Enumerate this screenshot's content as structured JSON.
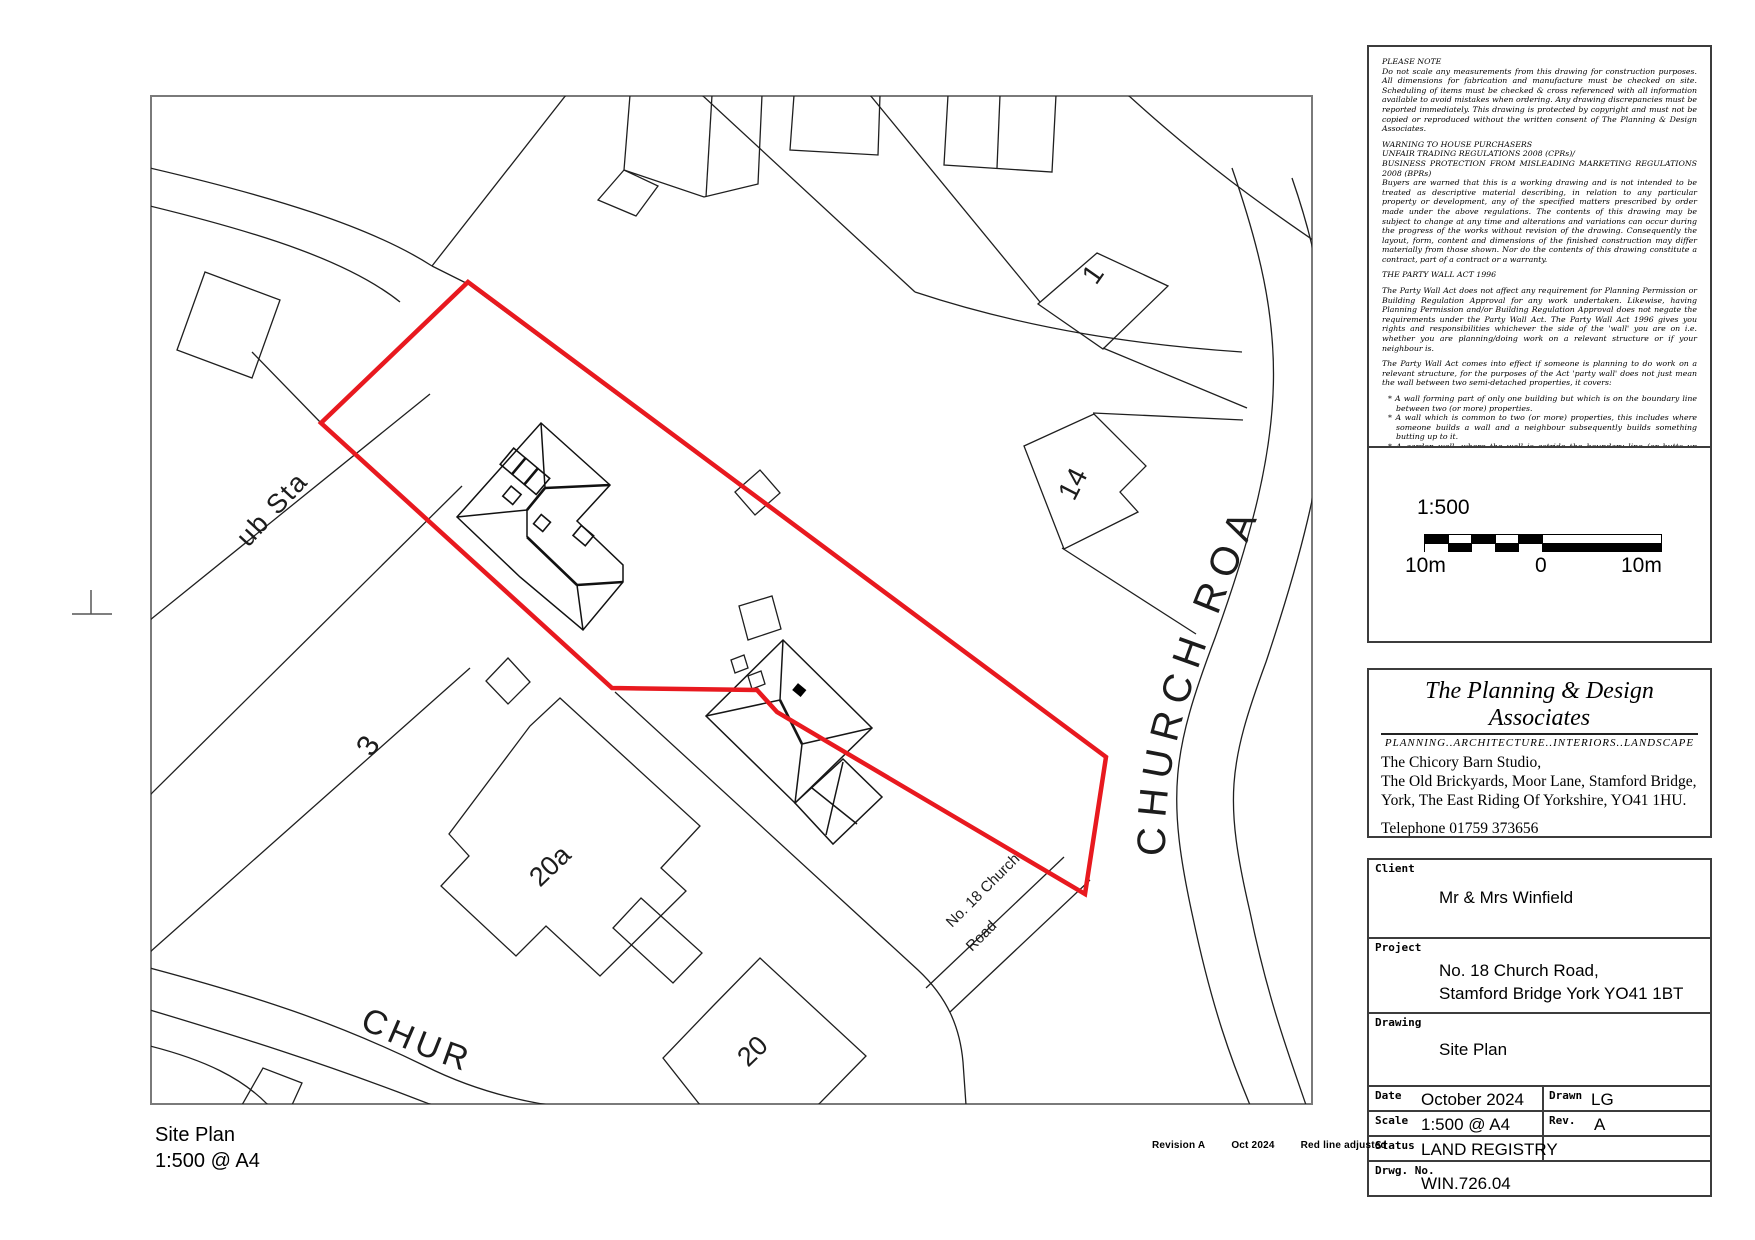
{
  "plan": {
    "boundary_color": "#e8191f",
    "labels": {
      "substation": "ub Sta",
      "plot3": "3",
      "plot20a": "20a",
      "plot20": "20",
      "plot1": "1",
      "plot14": "14",
      "road_right": "CHURCH ROA",
      "road_bottom": "CHUR",
      "subject_line1": "No. 18 Church",
      "subject_line2": "Road"
    }
  },
  "notes": {
    "h1": "PLEASE NOTE",
    "p1": "Do not scale any measurements from this drawing for construction purposes. All dimensions for fabrication and manufacture must be checked on site. Scheduling of items must be checked & cross referenced with all information available to avoid mistakes when ordering. Any drawing discrepancies must be reported immediately. This drawing is protected by copyright and must not be copied or reproduced without the written consent of The Planning & Design Associates.",
    "h2a": "WARNING TO HOUSE PURCHASERS",
    "h2b": "UNFAIR TRADING REGULATIONS 2008 (CPRs)/",
    "h2c": "BUSINESS PROTECTION FROM MISLEADING MARKETING REGULATIONS 2008 (BPRs)",
    "p2": "Buyers are warned that this is a working drawing and is not intended to be treated as descriptive material describing, in relation to any particular property or development, any of the specified matters prescribed by order made under the above regulations. The contents of this drawing may be subject to change at any time and alterations and variations can occur during the progress of the works without revision of the drawing. Consequently the layout, form, content and dimensions of the finished construction may differ materially from those shown. Nor do the contents of this drawing constitute a contract, part of a contract or a warranty.",
    "h3": "THE PARTY WALL ACT 1996",
    "p3": "The Party Wall Act does not affect any requirement for Planning Permission or Building Regulation Approval for any work undertaken. Likewise, having Planning Permission and/or Building Regulation Approval does not negate the requirements under the Party Wall Act. The Party Wall Act 1996 gives you rights and responsibilities whichever the side of the 'wall' you are on i.e. whether you are planning/doing work on a relevant structure or if your neighbour is.",
    "p4": "The Party Wall Act comes into effect if someone is planning to do work on a relevant structure, for the purposes of the Act 'party wall' does not just mean the wall between two semi-detached properties, it covers:",
    "b1": "* A wall forming part of only one building but which is on the boundary line between two (or more) properties.",
    "b2": "* A wall which is common to two (or more) properties, this includes where someone builds a wall and a neighbour subsequently builds something butting up to it.",
    "b3": "* A garden wall, where the wall is astride the boundary line (or butts up against it) and is used to separate the properties but is not part of any building.",
    "b4": "* Floors and ceilings of flats etc.",
    "b5": "* Excavation near to a neighbouring property.",
    "p5": "As with all work affecting neighbours, it is always better to reach a friendly agreement rather than resort to any law. Even where the work requires a notice to be served, it is better to informally discuss the intended work, consider the neighbours comments, and amend your plans (if appropriate) before serving the notice. If there is any doubt please consult The Planning & Design Associates or a party wall surveyor."
  },
  "scalebar": {
    "ratio": "1:500",
    "label_left": "10m",
    "label_zero": "0",
    "label_right": "10m"
  },
  "company": {
    "name": "The Planning & Design Associates",
    "tagline": "PLANNING..ARCHITECTURE..INTERIORS..LANDSCAPE",
    "address1": "The Chicory Barn Studio,",
    "address2": "The Old Brickyards, Moor Lane, Stamford Bridge,",
    "address3": "York, The East Riding Of Yorkshire, YO41 1HU.",
    "phone": "Telephone 01759 373656",
    "email_label": "E-mail:",
    "email": "pdaenquiries@the-pdassociates.co.uk",
    "website_label": "website:",
    "website": "www.the-pdassociates.co.uk"
  },
  "titleblock": {
    "client_label": "Client",
    "client": "Mr & Mrs Winfield",
    "project_label": "Project",
    "project_line1": "No. 18 Church Road,",
    "project_line2": "Stamford Bridge York YO41 1BT",
    "drawing_label": "Drawing",
    "drawing": "Site Plan",
    "date_label": "Date",
    "date": "October 2024",
    "drawn_label": "Drawn",
    "drawn": "LG",
    "scale_label": "Scale",
    "scale": "1:500 @ A4",
    "rev_label": "Rev.",
    "rev": "A",
    "status_label": "Status",
    "status": "LAND REGISTRY",
    "drwg_label": "Drwg. No.",
    "drwg_no": "WIN.726.04"
  },
  "footer": {
    "title_line1": "Site Plan",
    "title_line2": "1:500 @ A4",
    "revision": "Revision A",
    "revision_date": "Oct 2024",
    "revision_note": "Red line adjusted"
  }
}
